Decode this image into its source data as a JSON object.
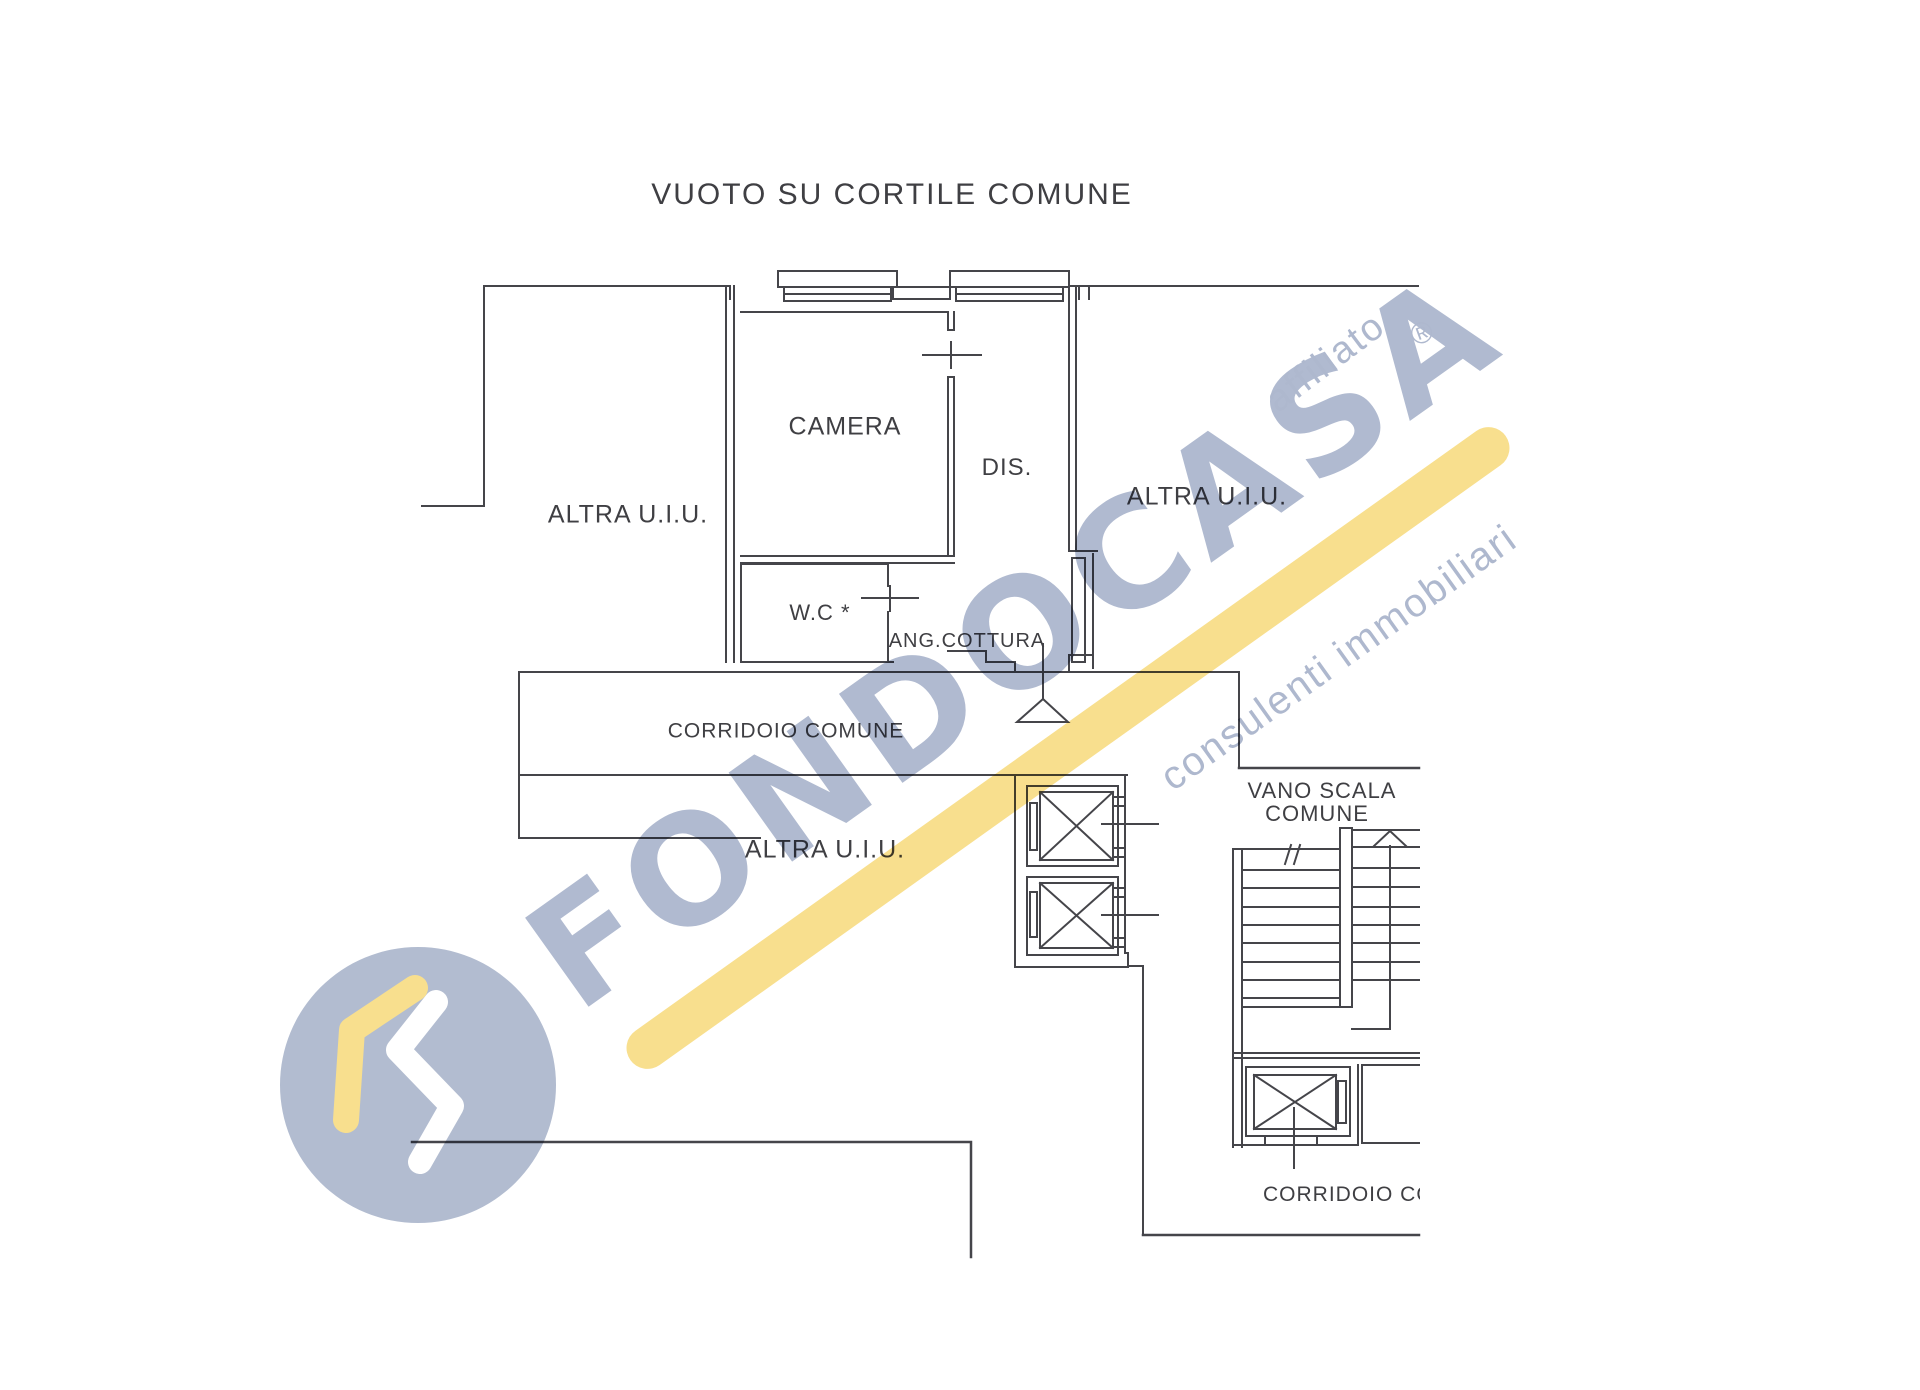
{
  "plan": {
    "title": "VUOTO SU CORTILE COMUNE",
    "labels": {
      "altra_uiu_left": "ALTRA U.I.U.",
      "camera": "CAMERA",
      "dis": "DIS.",
      "altra_uiu_right": "ALTRA U.I.U.",
      "wc": "W.C *",
      "ang_cottura": "ANG.COTTURA",
      "corridoio_comune": "CORRIDOIO COMUNE",
      "altra_uiu_lower": "ALTRA U.I.U.",
      "vano_scala_line1": "VANO SCALA",
      "vano_scala_line2": "COMUNE",
      "corridoio_bottom_truncated": "CORRIDOIO CO"
    },
    "line_color": "#45454a",
    "text_color": "#3f3f43"
  },
  "watermark": {
    "brand": "FONDOCASA",
    "affiliato_label": "affiliato",
    "registered_mark": "®",
    "tagline": "consulenti immobiliari",
    "blue": "#b0bad0",
    "yellow": "#f8df8e"
  }
}
